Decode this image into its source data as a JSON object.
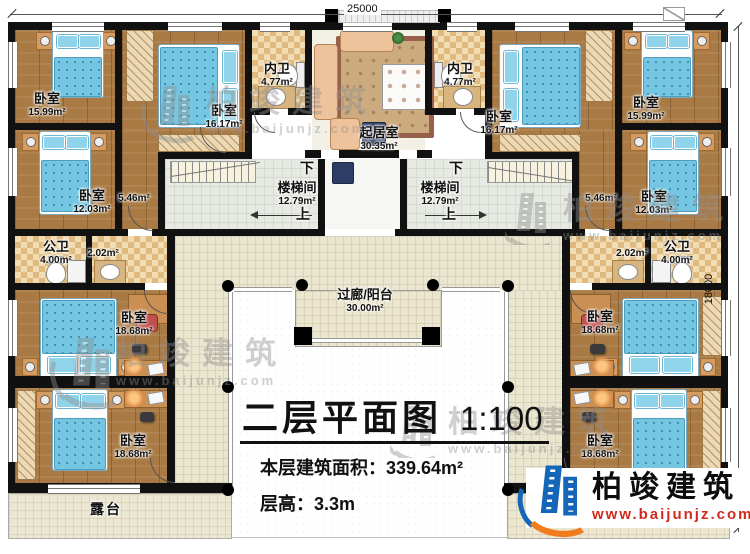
{
  "dimensions": {
    "top": "25000",
    "right": "18000"
  },
  "stair": {
    "room": "楼梯间",
    "area": "12.79m²",
    "down": "下",
    "up": "上"
  },
  "rooms": {
    "bedroom_tl": {
      "name": "卧室",
      "area": "15.99m²"
    },
    "bedroom_tl2": {
      "name": "卧室",
      "area": "16.17m²"
    },
    "innerbath_l": {
      "name": "内卫",
      "area": "4.77m²"
    },
    "living": {
      "name": "起居室",
      "area": "30.35m²"
    },
    "innerbath_r": {
      "name": "内卫",
      "area": "4.77m²"
    },
    "bedroom_tr2": {
      "name": "卧室",
      "area": "16.17m²"
    },
    "bedroom_tr": {
      "name": "卧室",
      "area": "15.99m²"
    },
    "bedroom_l2": {
      "name": "卧室",
      "area": "12.03m²"
    },
    "hall_l": {
      "area": "5.46m²"
    },
    "hall_r": {
      "area": "5.46m²"
    },
    "bedroom_r2": {
      "name": "卧室",
      "area": "12.03m²"
    },
    "pubbath_l": {
      "name": "公卫",
      "area": "4.00m²"
    },
    "hall_l2": {
      "area": "2.02m²"
    },
    "hall_r2": {
      "area": "2.02m²"
    },
    "pubbath_r": {
      "name": "公卫",
      "area": "4.00m²"
    },
    "bedroom_lm": {
      "name": "卧室",
      "area": "18.68m²"
    },
    "bedroom_rm": {
      "name": "卧室",
      "area": "18.68m²"
    },
    "balcony": {
      "name": "过廊/阳台",
      "area": "30.00m²"
    },
    "bedroom_lb": {
      "name": "卧室",
      "area": "18.68m²"
    },
    "bedroom_rb": {
      "name": "卧室",
      "area": "18.68m²"
    },
    "terrace": {
      "name": "露台"
    }
  },
  "title_block": {
    "title": "二层平面图",
    "scale": "1:100",
    "area_label": "本层建筑面积：",
    "area_value": "339.64m²",
    "floor_height_label": "层高：",
    "floor_height_value": "3.3m"
  },
  "logo": {
    "company": "柏竣建筑",
    "website": "www.baijunjz.com"
  },
  "watermark": {
    "company": "柏竣建筑",
    "website": "www.baijunjz.com"
  }
}
